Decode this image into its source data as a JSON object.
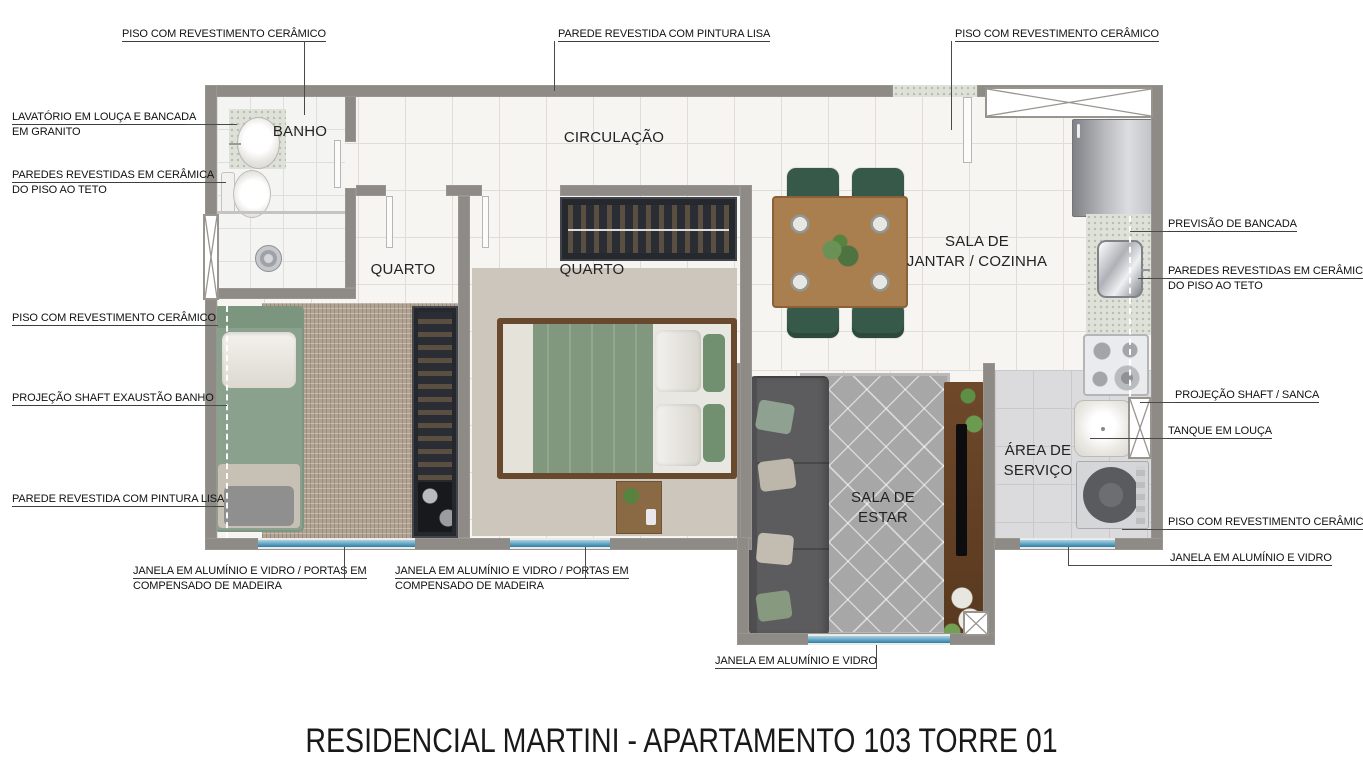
{
  "title": "RESIDENCIAL MARTINI - APARTAMENTO 103 TORRE 01",
  "rooms": {
    "banho": "BANHO",
    "circulacao": "CIRCULAÇÃO",
    "quarto_1": "QUARTO",
    "quarto_2": "QUARTO",
    "sala_jantar_cozinha": "SALA DE\nJANTAR / COZINHA",
    "sala_estar": "SALA DE\nESTAR",
    "area_servico": "ÁREA DE\nSERVIÇO"
  },
  "ann": {
    "tl_piso": [
      "PISO COM REVESTIMENTO CERÂMICO"
    ],
    "top_parede": [
      "PAREDE REVESTIDA COM PINTURA LISA"
    ],
    "tr_piso": [
      "PISO COM REVESTIMENTO CERÂMICO"
    ],
    "lavatorio": [
      "LAVATÓRIO EM LOUÇA E BANCADA",
      "EM GRANITO"
    ],
    "paredes_ceramica_l": [
      "PAREDES REVESTIDAS EM CERÂMICA",
      "DO PISO AO TETO"
    ],
    "piso_l": [
      "PISO COM REVESTIMENTO CERÂMICO"
    ],
    "shaft_banho": [
      "PROJEÇÃO SHAFT EXAUSTÃO BANHO"
    ],
    "parede_l": [
      "PAREDE REVESTIDA COM PINTURA LISA"
    ],
    "janela_portas_1": [
      "JANELA EM ALUMÍNIO E VIDRO / PORTAS EM",
      "COMPENSADO DE MADEIRA"
    ],
    "janela_portas_2": [
      "JANELA EM ALUMÍNIO E VIDRO / PORTAS EM",
      "COMPENSADO DE MADEIRA"
    ],
    "janela_b": [
      "JANELA EM ALUMÍNIO E VIDRO"
    ],
    "previsao": [
      "PREVISÃO DE BANCADA"
    ],
    "paredes_ceramica_r": [
      "PAREDES REVESTIDAS EM CERÂMICA",
      "DO PISO AO TETO"
    ],
    "shaft_sanca": [
      "PROJEÇÃO SHAFT / SANCA"
    ],
    "tanque": [
      "TANQUE EM LOUÇA"
    ],
    "piso_r": [
      "PISO COM REVESTIMENTO CERÂMICO"
    ],
    "janela_r": [
      "JANELA EM ALUMÍNIO E VIDRO"
    ]
  },
  "palette": {
    "wall": "#8e8b86",
    "floor_tile": "#f6f5f2",
    "window_glass": "#2e7da7",
    "chair_green": "#37594a",
    "wood": "#a97f50",
    "label_text": "#101010"
  }
}
